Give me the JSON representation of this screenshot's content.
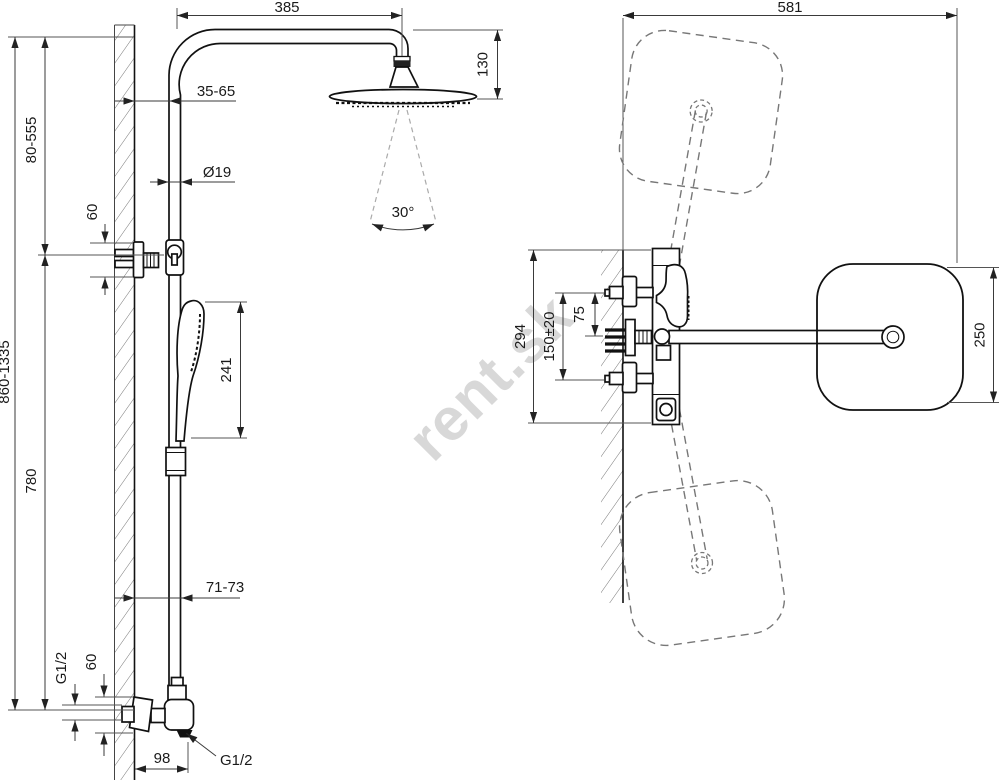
{
  "watermark": {
    "text": "rent.sk"
  },
  "left_view": {
    "dim_arm_reach": "385",
    "dim_head_drop": "130",
    "dim_wall_to_pipe_top": "35-65",
    "dim_pipe_diameter": "Ø19",
    "dim_bracket_height": "60",
    "dim_upper_adjust_range": "80-555",
    "dim_overall_height": "860-1335",
    "dim_hand_shower_length": "241",
    "dim_rail_length": "780",
    "dim_wall_to_pipe_bottom": "71-73",
    "dim_spray_angle": "30°",
    "dim_inlet_thread": "G1/2",
    "dim_valve_body_height": "60",
    "dim_valve_depth": "98",
    "dim_outlet_thread": "G1/2"
  },
  "right_view": {
    "dim_overall_depth": "581",
    "dim_valve_assembly_height": "294",
    "dim_supply_spacing": "150±20",
    "dim_supply_to_arm": "75",
    "dim_head_width": "250"
  }
}
